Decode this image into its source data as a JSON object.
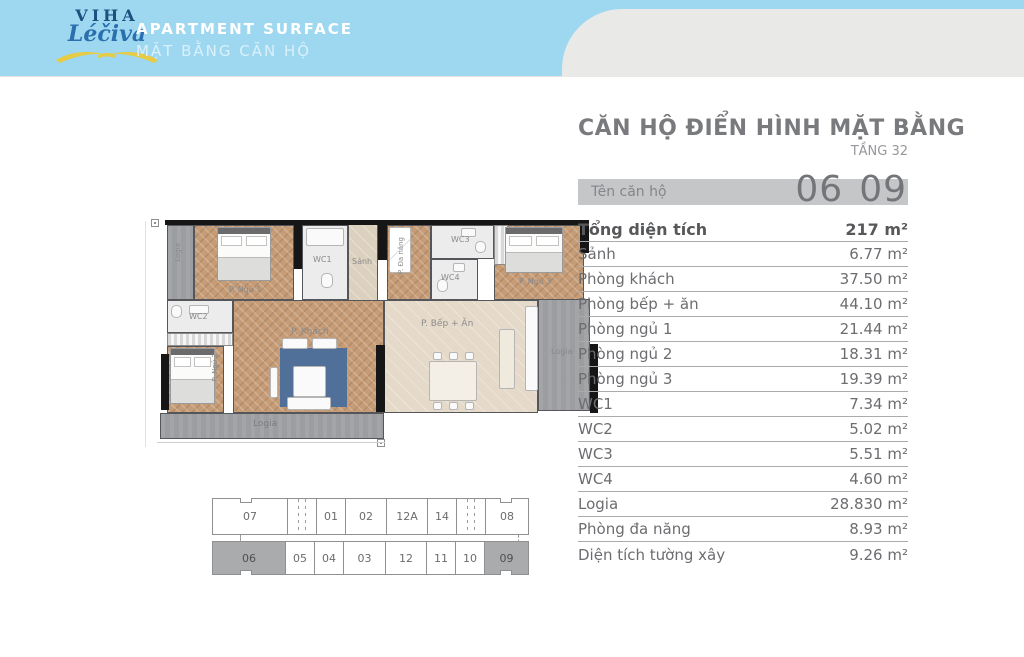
{
  "header": {
    "logo_line1": "VIHA",
    "logo_line2": "Léčiva",
    "title": "APARTMENT SURFACE",
    "subtitle": "MẶT BẰNG CĂN HỘ"
  },
  "panel": {
    "title": "CĂN HỘ ĐIỂN HÌNH MẶT BẰNG",
    "floor": "TẦNG 32",
    "unit_label": "Tên căn hộ",
    "units": [
      "06",
      "09"
    ],
    "rows": [
      {
        "label": "Tổng diện tích",
        "value": "217 m²"
      },
      {
        "label": "Sảnh",
        "value": "6.77 m²"
      },
      {
        "label": "Phòng khách",
        "value": "37.50 m²"
      },
      {
        "label": "Phòng bếp + ăn",
        "value": "44.10 m²"
      },
      {
        "label": "Phòng ngủ 1",
        "value": "21.44 m²"
      },
      {
        "label": "Phòng ngủ 2",
        "value": "18.31 m²"
      },
      {
        "label": "Phòng ngủ 3",
        "value": "19.39 m²"
      },
      {
        "label": "WC1",
        "value": "7.34 m²"
      },
      {
        "label": "WC2",
        "value": "5.02 m²"
      },
      {
        "label": "WC3",
        "value": "5.51 m²"
      },
      {
        "label": "WC4",
        "value": "4.60 m²"
      },
      {
        "label": "Logia",
        "value": "28.830 m²"
      },
      {
        "label": "Phòng đa năng",
        "value": "8.93 m²"
      },
      {
        "label": "Diện tích tường xây",
        "value": "9.26 m²"
      }
    ]
  },
  "floorplan": {
    "labels": {
      "logia_tl": "Logia",
      "bedroom1": "P. Ngủ 1",
      "wc1": "WC1",
      "hall": "Sảnh",
      "multipurpose": "P. Đa năng",
      "wc3": "WC3",
      "wc4": "WC4",
      "bedroom3": "P. Ngủ 3",
      "wc2": "WC2",
      "living": "P. Khách",
      "kitchen": "P. Bếp + Ăn",
      "bedroom2": "P. Ngủ 2",
      "logia_bottom": "Logia",
      "logia_right": "Logia"
    }
  },
  "keyplan": {
    "top_row": [
      "07",
      "01",
      "02",
      "12A",
      "14",
      "08"
    ],
    "bottom_row": [
      "06",
      "05",
      "04",
      "03",
      "12",
      "11",
      "10",
      "09"
    ],
    "highlighted": [
      "06",
      "09"
    ]
  },
  "colors": {
    "banner_blue": "#9ed7f0",
    "highlight_gray": "#aaabad",
    "accent_navy": "#1d4f7f"
  }
}
